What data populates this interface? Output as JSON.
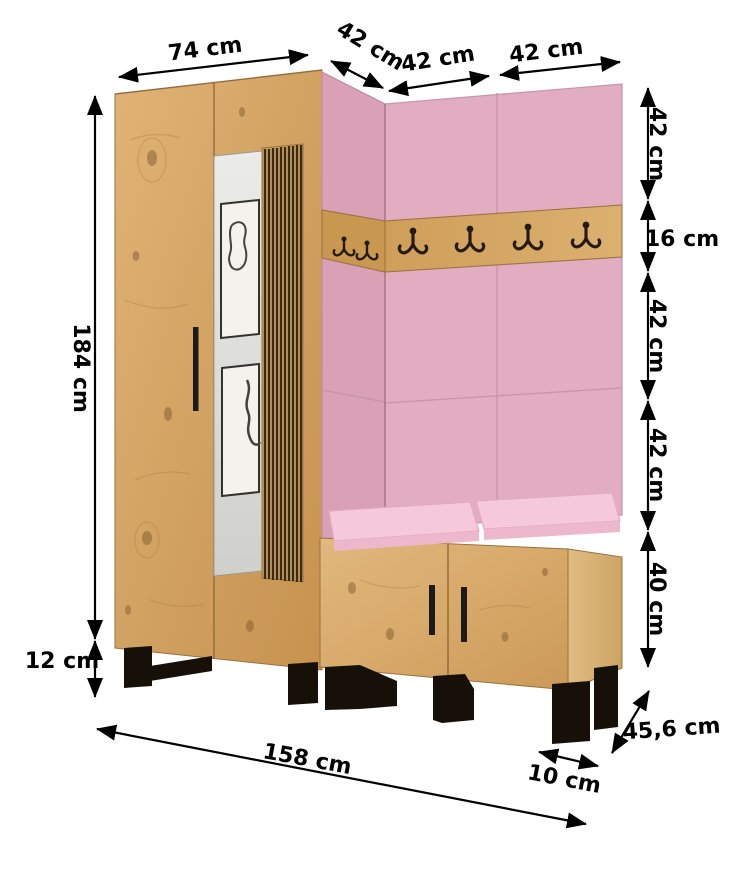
{
  "diagram": {
    "kind": "hallway-furniture-dimension-diagram",
    "colors": {
      "background": "#ffffff",
      "wood": "#d2a262",
      "wood_light": "#e0b579",
      "wood_side": "#d9b279",
      "panel_pink": "#e3adc1",
      "panel_pink_shaded": "#d9a0b6",
      "cushion_pink": "#f6c9da",
      "mirror_grey": "#d9dad6",
      "leg_black": "#171008",
      "dimension": "#000000"
    },
    "dims": {
      "w74": "74 cm",
      "w42corner": "42 cm",
      "w42a": "42 cm",
      "w42b": "42 cm",
      "h42a": "42 cm",
      "h16": "16 cm",
      "h42b": "42 cm",
      "h42c": "42 cm",
      "h40": "40 cm",
      "h184": "184 cm",
      "h12": "12 cm",
      "w158": "158 cm",
      "w10": "10 cm",
      "d456": "45,6 cm"
    }
  }
}
